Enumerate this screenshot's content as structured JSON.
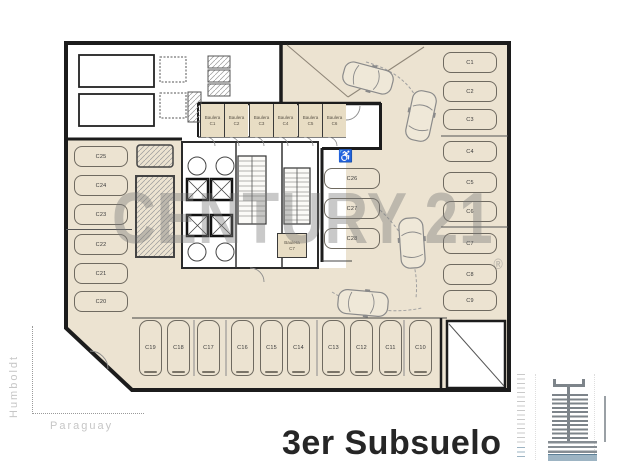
{
  "page": {
    "title": "3er Subsuelo"
  },
  "watermark": {
    "text": "CENTURY 21",
    "registered": "®"
  },
  "streets": {
    "left": "Humboldt",
    "bottom": "Paraguay"
  },
  "icons": {
    "accessible": "♿"
  },
  "parking": {
    "left": [
      "C25",
      "C24",
      "C23",
      "C22",
      "C21",
      "C20"
    ],
    "right": [
      "C1",
      "C2",
      "C3",
      "C4",
      "C5",
      "C6",
      "C7",
      "C8",
      "C9"
    ],
    "center": [
      "C26",
      "C27",
      "C28"
    ],
    "bottom": [
      "C19",
      "C18",
      "C17",
      "C16",
      "C15",
      "C14",
      "C13",
      "C12",
      "C11",
      "C10"
    ]
  },
  "storage": {
    "row": [
      {
        "name": "Baulera",
        "code": "C1"
      },
      {
        "name": "Baulera",
        "code": "C2"
      },
      {
        "name": "Baulera",
        "code": "C3"
      },
      {
        "name": "Baulera",
        "code": "C4"
      },
      {
        "name": "Baulera",
        "code": "C5"
      },
      {
        "name": "Baulera",
        "code": "C6"
      }
    ],
    "core": {
      "name": "Baulera",
      "code": "C7"
    }
  },
  "colors": {
    "floor": "#ece3d1",
    "wall": "#1c1c1c",
    "accent_blue": "#9db4c3",
    "watermark_gray": "#8f8f8f"
  }
}
